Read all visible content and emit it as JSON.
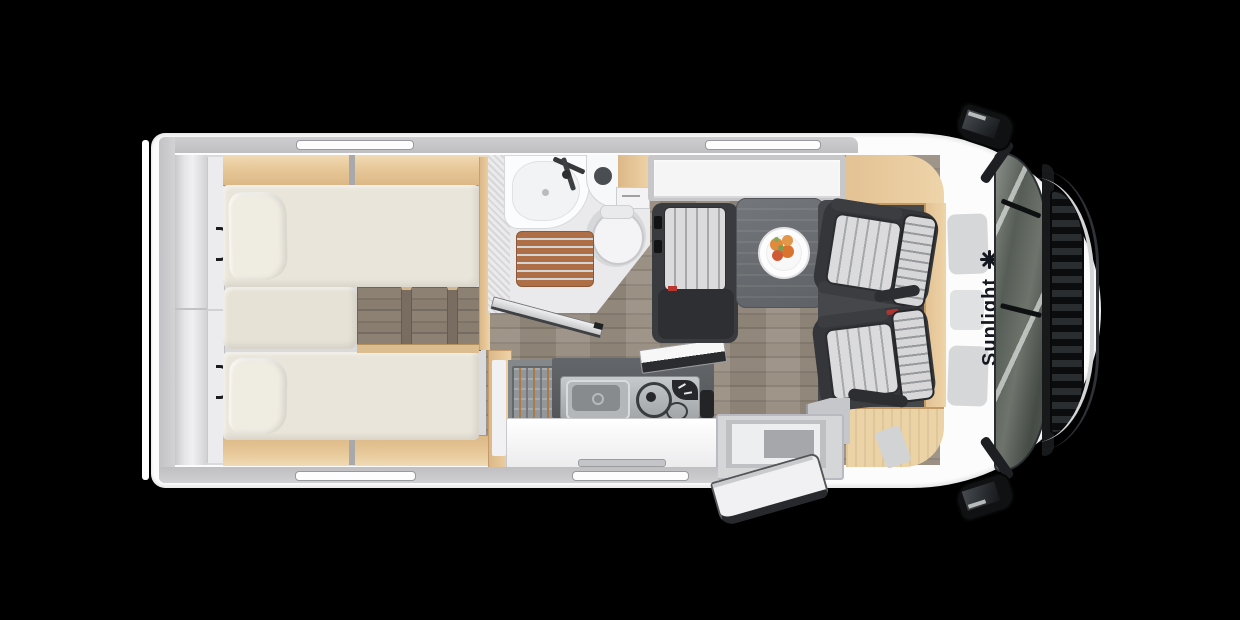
{
  "brand": {
    "logo_text": "Sunlight",
    "logo_icon": "sun-asterisk",
    "logo_color": "#14171f"
  },
  "floorplan": {
    "view": "top-down motorhome floor plan",
    "areas": [
      {
        "id": "rear-garage",
        "label": "rear storage"
      },
      {
        "id": "twin-beds",
        "label": "two single beds with pillows and center steps"
      },
      {
        "id": "bathroom",
        "label": "washroom with basin, faucet, toilet, shower grate, open door"
      },
      {
        "id": "overhead-locker",
        "label": "white overhead locker"
      },
      {
        "id": "kitchen",
        "label": "kitchenette with sink, two-burner hob, open glass lid, utensil rack"
      },
      {
        "id": "dinette",
        "label": "lounge bench with table and fruit plate"
      },
      {
        "id": "cab",
        "label": "driver cab with two swivelled pilot seats"
      },
      {
        "id": "entry",
        "label": "entry step with open entrance door"
      }
    ],
    "colors": {
      "background": "#000000",
      "body_white": "#fcfcfd",
      "wall_gray": "#c6c6c9",
      "wood_light": "#e4c296",
      "mattress_cream": "#e9e5da",
      "floor_plank": "#91867a",
      "upholstery_dark": "#36383c",
      "upholstery_stripe": "#d7d7d9",
      "shower_grate": "#ae6f46",
      "table_gray": "#6b6e72",
      "accent_red": "#b9372f"
    }
  }
}
